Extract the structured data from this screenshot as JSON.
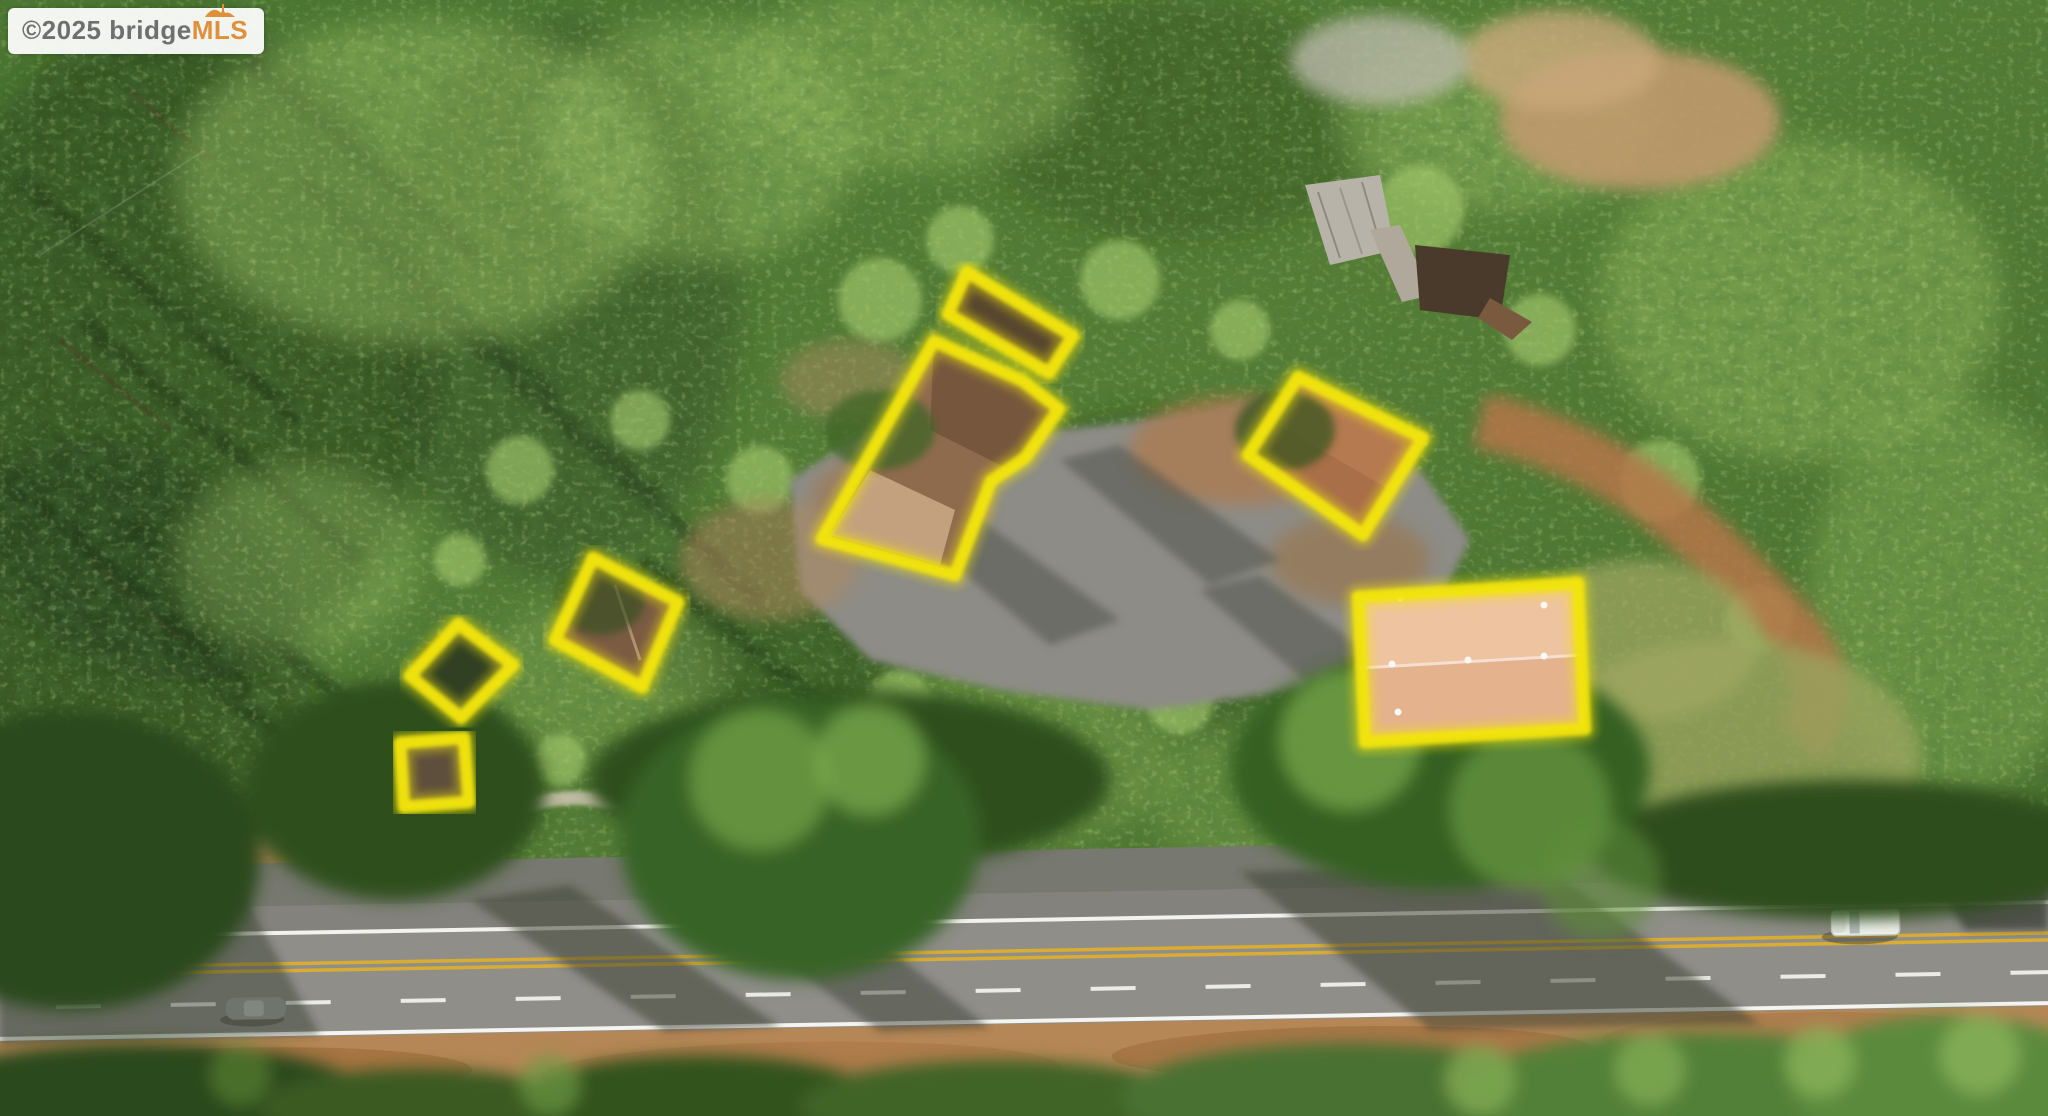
{
  "watermark": {
    "copyright": "©2025 ",
    "brand": "bridge",
    "brand_suffix": "MLS",
    "brand_color": "#6f6f6f",
    "suffix_color": "#e0903a"
  },
  "annotation": {
    "highlight_color": "#f2e40c",
    "structures": [
      {
        "name": "shed-north",
        "points": "967,272 1073,336 1049,373 948,314"
      },
      {
        "name": "main-house",
        "points": "934,341 1023,381 1059,409 1025,458 991,481 955,575 822,539"
      },
      {
        "name": "garage",
        "points": "593,558 678,602 642,687 555,640"
      },
      {
        "name": "outbuilding-west",
        "points": "458,624 513,665 461,718 410,676"
      },
      {
        "name": "outbuilding-south",
        "points": "400,743 464,738 469,802 404,807"
      },
      {
        "name": "house-east",
        "points": "1298,377 1423,438 1363,535 1248,455"
      },
      {
        "name": "workshop-east",
        "points": "1358,597 1578,583 1585,729 1365,742"
      }
    ]
  }
}
